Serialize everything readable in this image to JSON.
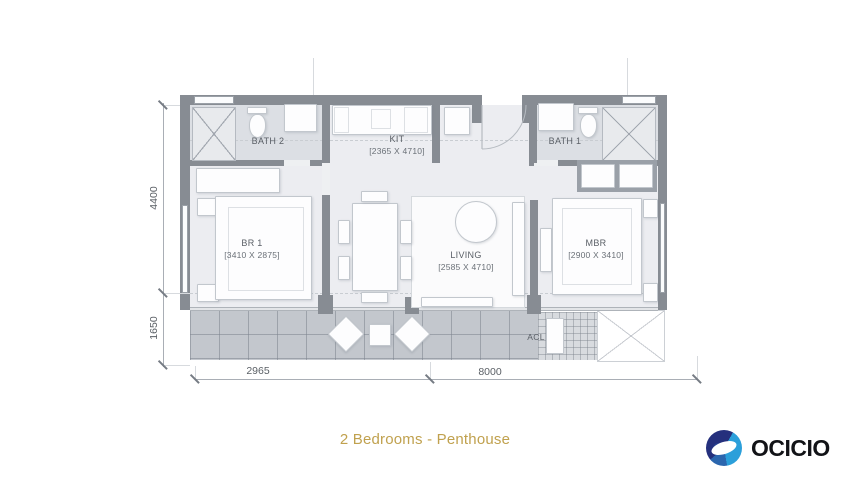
{
  "title": "2 Bedrooms - Penthouse",
  "logo": {
    "text": "OCICIO"
  },
  "rooms": {
    "bath2": {
      "name": "BATH 2"
    },
    "kit": {
      "name": "KIT",
      "dims": "[2365 X 4710]"
    },
    "bath1": {
      "name": "BATH 1"
    },
    "br1": {
      "name": "BR 1",
      "dims": "[3410 X 2875]"
    },
    "living": {
      "name": "LIVING",
      "dims": "[2585 X 4710]"
    },
    "mbr": {
      "name": "MBR",
      "dims": "[2900 X 3410]"
    },
    "acl": {
      "name": "ACL"
    }
  },
  "dimensions": {
    "left_top": "4400",
    "left_bottom": "1650",
    "bottom_left": "2965",
    "bottom_right": "8000"
  },
  "colors": {
    "accent_gold": "#c0a14e",
    "wall_gray": "#878c93",
    "logo_navy": "#25307d",
    "logo_blue": "#2b9fda"
  }
}
